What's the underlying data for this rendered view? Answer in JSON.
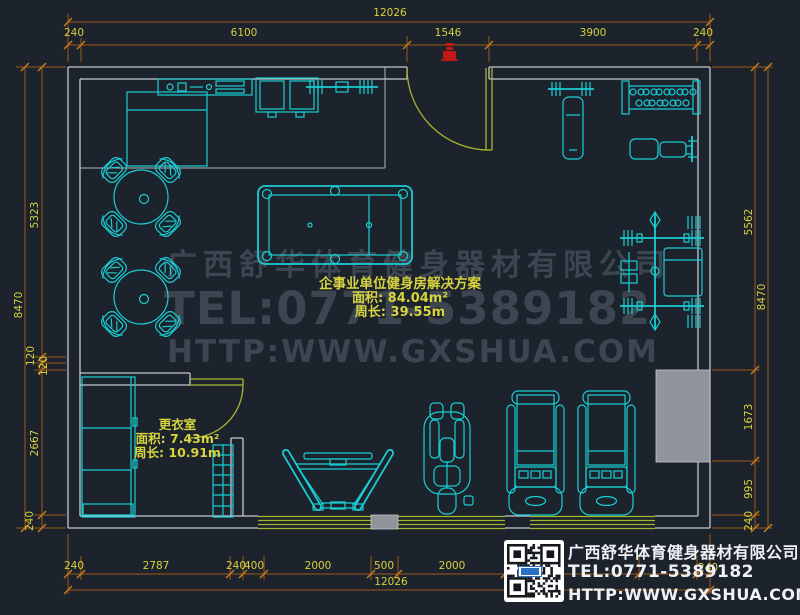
{
  "watermark": {
    "company": "广西舒华体育健身器材有限公司",
    "tel": "TEL:0771-5389182",
    "url": "HTTP:WWW.GXSHUA.COM"
  },
  "title_block": {
    "company": "广西舒华体育健身器材有限公司",
    "tel": "TEL:0771-5389182",
    "url": "HTTP:WWW.GXSHUA.COM"
  },
  "plan_labels": {
    "solution_title": "企事业单位健身房解决方案",
    "solution_area": "面积: 84.04m²",
    "solution_perimeter": "周长: 39.55m",
    "changing_room_name": "更衣室",
    "changing_room_area": "面积: 7.43m²",
    "changing_room_perimeter": "周长: 10.91m"
  },
  "dimensions": {
    "top_total": "12026",
    "top": [
      "240",
      "6100",
      "1546",
      "3900",
      "240"
    ],
    "bottom": [
      "240",
      "2787",
      "240",
      "400",
      "2000",
      "500",
      "2000",
      "240"
    ],
    "bottom_total": "12026",
    "left": [
      "5323",
      "120",
      "120",
      "2667",
      "240"
    ],
    "left_total": "8470",
    "right": [
      "5562",
      "1673",
      "995",
      "240"
    ],
    "right_total": "8470"
  },
  "colors": {
    "background": "#1c232c",
    "wall": "#c4c9cd",
    "equipment_cyan": "#19ced4",
    "dimension_line": "#a05a1a",
    "dimension_text": "#d6d13d",
    "door_window_green": "#a2b82c",
    "red_marker": "#c41718",
    "watermark_gray": "#3d4550",
    "column_gray": "#8f959b",
    "footer_text": "#eef2f5"
  }
}
